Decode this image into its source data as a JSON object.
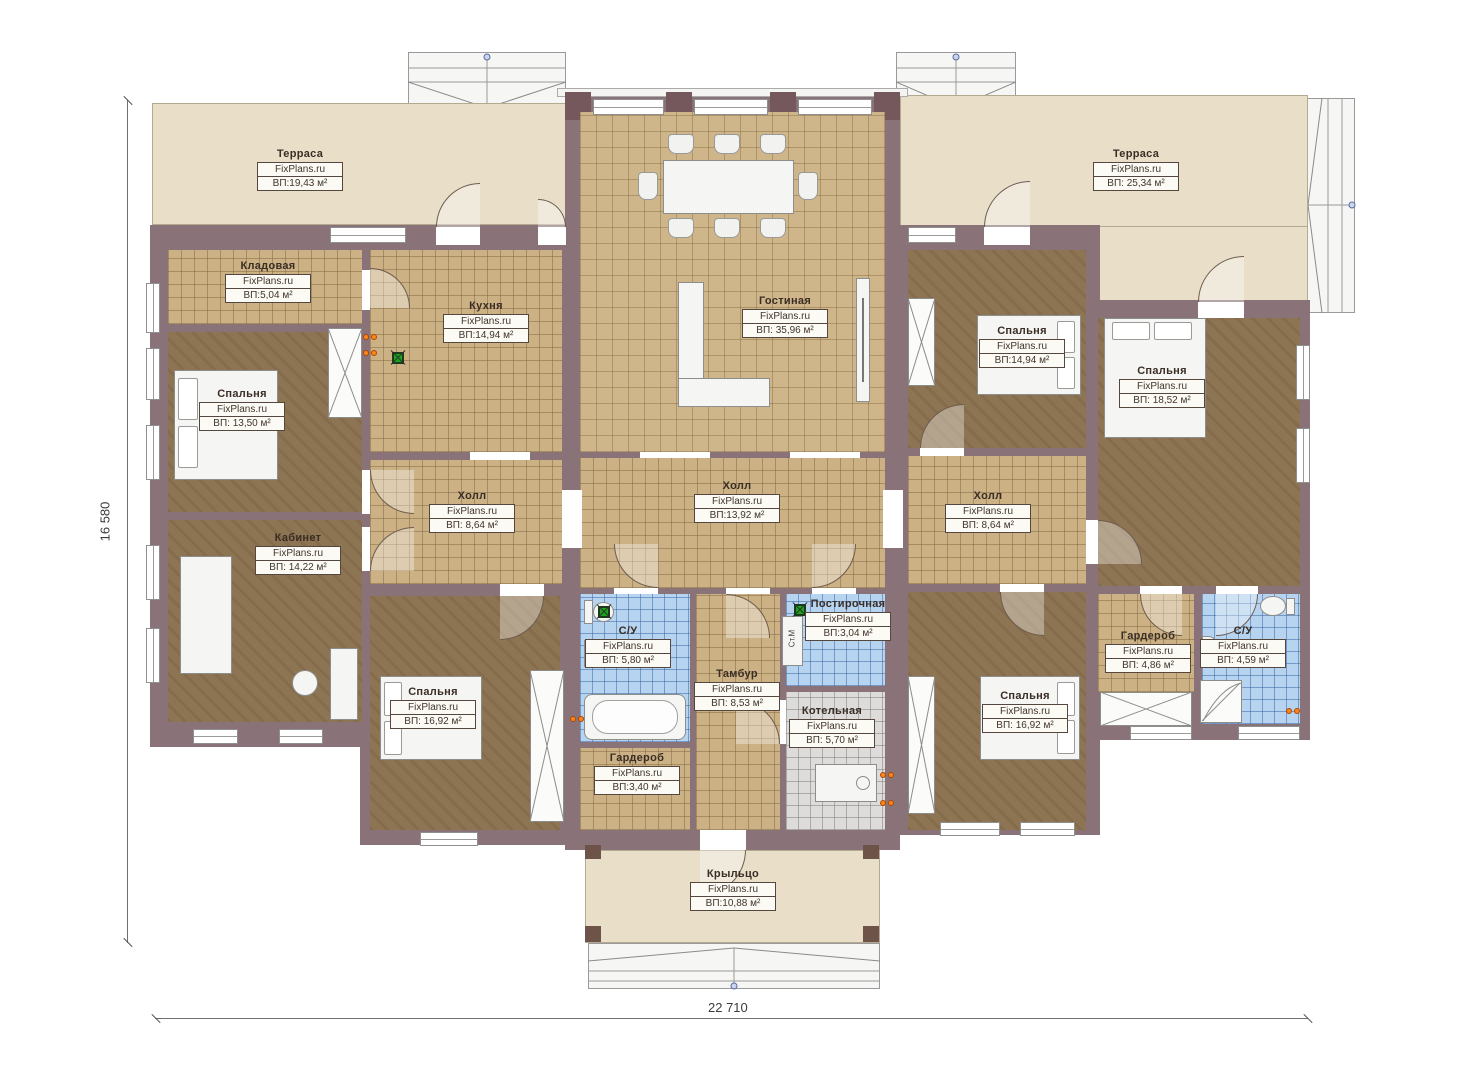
{
  "brand": "FixPlans.ru",
  "dimensions": {
    "height": "16 580",
    "width": "22 710"
  },
  "washer_label": "Ст.М",
  "rooms": {
    "terrace_left": {
      "name": "Терраса",
      "brand": "FixPlans.ru",
      "area": "ВП:19,43 м²"
    },
    "terrace_right": {
      "name": "Терраса",
      "brand": "FixPlans.ru",
      "area": "ВП: 25,34 м²"
    },
    "storage": {
      "name": "Кладовая",
      "brand": "FixPlans.ru",
      "area": "ВП:5,04 м²"
    },
    "kitchen": {
      "name": "Кухня",
      "brand": "FixPlans.ru",
      "area": "ВП:14,94 м²"
    },
    "living_room": {
      "name": "Гостиная",
      "brand": "FixPlans.ru",
      "area": "ВП: 35,96 м²"
    },
    "bedroom_nw": {
      "name": "Спальня",
      "brand": "FixPlans.ru",
      "area": "ВП: 13,50 м²"
    },
    "office": {
      "name": "Кабинет",
      "brand": "FixPlans.ru",
      "area": "ВП: 14,22 м²"
    },
    "hall_left": {
      "name": "Холл",
      "brand": "FixPlans.ru",
      "area": "ВП: 8,64 м²"
    },
    "hall_center": {
      "name": "Холл",
      "brand": "FixPlans.ru",
      "area": "ВП:13,92 м²"
    },
    "hall_right": {
      "name": "Холл",
      "brand": "FixPlans.ru",
      "area": "ВП: 8,64 м²"
    },
    "bathroom_left": {
      "name": "С/У",
      "brand": "FixPlans.ru",
      "area": "ВП: 5,80 м²"
    },
    "laundry": {
      "name": "Постирочная",
      "brand": "FixPlans.ru",
      "area": "ВП:3,04 м²"
    },
    "vestibule": {
      "name": "Тамбур",
      "brand": "FixPlans.ru",
      "area": "ВП: 8,53 м²"
    },
    "boiler_room": {
      "name": "Котельная",
      "brand": "FixPlans.ru",
      "area": "ВП: 5,70 м²"
    },
    "wardrobe_center": {
      "name": "Гардероб",
      "brand": "FixPlans.ru",
      "area": "ВП:3,40 м²"
    },
    "bedroom_sw": {
      "name": "Спальня",
      "brand": "FixPlans.ru",
      "area": "ВП: 16,92 м²"
    },
    "bedroom_ne": {
      "name": "Спальня",
      "brand": "FixPlans.ru",
      "area": "ВП:14,94 м²"
    },
    "bedroom_e": {
      "name": "Спальня",
      "brand": "FixPlans.ru",
      "area": "ВП: 18,52 м²"
    },
    "bedroom_se": {
      "name": "Спальня",
      "brand": "FixPlans.ru",
      "area": "ВП: 16,92 м²"
    },
    "wardrobe_right": {
      "name": "Гардероб",
      "brand": "FixPlans.ru",
      "area": "ВП: 4,86 м²"
    },
    "bathroom_right": {
      "name": "С/У",
      "brand": "FixPlans.ru",
      "area": "ВП: 4,59 м²"
    },
    "porch": {
      "name": "Крыльцо",
      "brand": "FixPlans.ru",
      "area": "ВП:10,88 м²"
    }
  },
  "colors": {
    "wall": "#897379",
    "pillar": "#74585c",
    "terrace": "#e9dfc9",
    "tile": "#cbb184",
    "bedroom_floor": "#8d7452",
    "bathroom_tile": "#b6d3ef",
    "boiler_tile": "#dddcda",
    "lamp_green": "#1ca21c",
    "socket_orange": "#ff831c"
  }
}
